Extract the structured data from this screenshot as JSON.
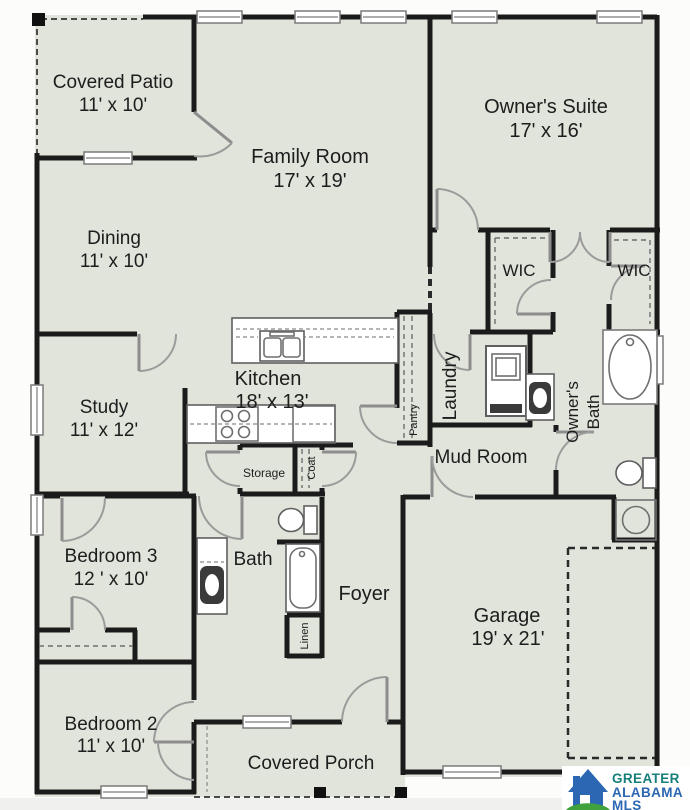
{
  "plan_title": "Single-story residential floor plan",
  "colors": {
    "floor": "#e1e4db",
    "wall": "#1b1b1b",
    "logo_blue": "#2b67b2",
    "logo_green": "#3fa23c",
    "logo_teal": "#15807a"
  },
  "rooms": {
    "covered_patio": {
      "name": "Covered Patio",
      "dims": "11' x 10'"
    },
    "family_room": {
      "name": "Family Room",
      "dims": "17' x 19'"
    },
    "owners_suite": {
      "name": "Owner's Suite",
      "dims": "17' x 16'"
    },
    "dining": {
      "name": "Dining",
      "dims": "11' x 10'"
    },
    "study": {
      "name": "Study",
      "dims": "11' x 12'"
    },
    "kitchen": {
      "name": "Kitchen",
      "dims": "18' x 13'"
    },
    "wic_left": {
      "name": "WIC"
    },
    "wic_right": {
      "name": "WIC"
    },
    "laundry": {
      "name": "Laundry"
    },
    "pantry": {
      "name": "Pantry"
    },
    "owners_bath": {
      "line1": "Owner's",
      "line2": "Bath"
    },
    "mud_room": {
      "name": "Mud Room"
    },
    "storage": {
      "name": "Storage"
    },
    "coat": {
      "name": "Coat"
    },
    "bedroom_3": {
      "name": "Bedroom 3",
      "dims": "12 ' x 10'"
    },
    "bath": {
      "name": "Bath"
    },
    "foyer": {
      "name": "Foyer"
    },
    "linen": {
      "name": "Linen"
    },
    "bedroom_2": {
      "name": "Bedroom 2",
      "dims": "11' x 10'"
    },
    "garage": {
      "name": "Garage",
      "dims": "19' x 21'"
    },
    "covered_porch": {
      "name": "Covered Porch"
    }
  },
  "logo": {
    "line1": "GREATER",
    "line2": "ALABAMA",
    "line3": "MLS"
  }
}
